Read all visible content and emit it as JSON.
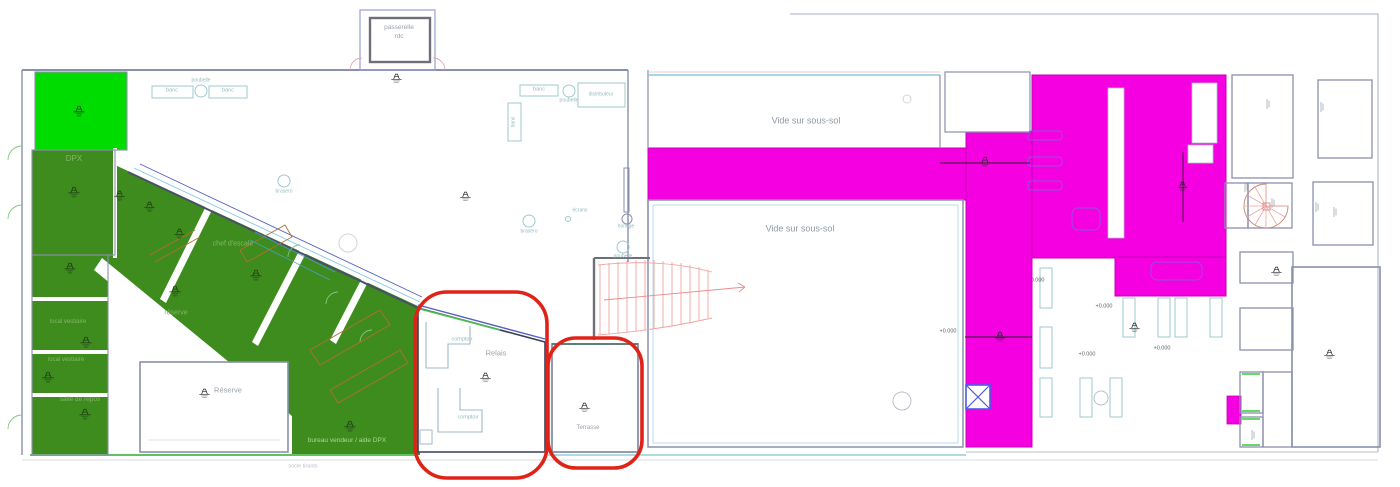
{
  "plan_type": "architectural-floor-plan",
  "labels": {
    "passerelle_line1": "passerelle",
    "passerelle_line2": "rdc",
    "banc": "banc",
    "poubelle": "poubelle",
    "distributeur": "distributeur",
    "brasero": "brasero",
    "ecrans": "écrans",
    "horloge": "horloge",
    "vide_sous_sol": "Vide sur sous-sol",
    "dpx": "DPX",
    "chef_escale": "chef d'escale",
    "reserve_small": "réserve",
    "local_vestiaire": "local vestiaire",
    "salle_repos": "salle de repos",
    "reserve_cap": "Réserve",
    "bureau_vendeur": "bureau vendeur / aide DPX",
    "socle_tirants": "socle tirants",
    "relais": "Relais",
    "comptoir": "comptoir",
    "terrasse": "Terrasse",
    "elevation": "+0.000"
  },
  "colors": {
    "magenta_zone": "#F500E0",
    "green_bright_zone": "#00DC00",
    "green_dark_zone": "#3E8C1E",
    "annotation_red": "#E02318",
    "wall": "#8A90AC",
    "furniture_teal": "#9FC8CE",
    "stair_red": "#F0A3A0",
    "label_gray": "#99A1AB"
  }
}
